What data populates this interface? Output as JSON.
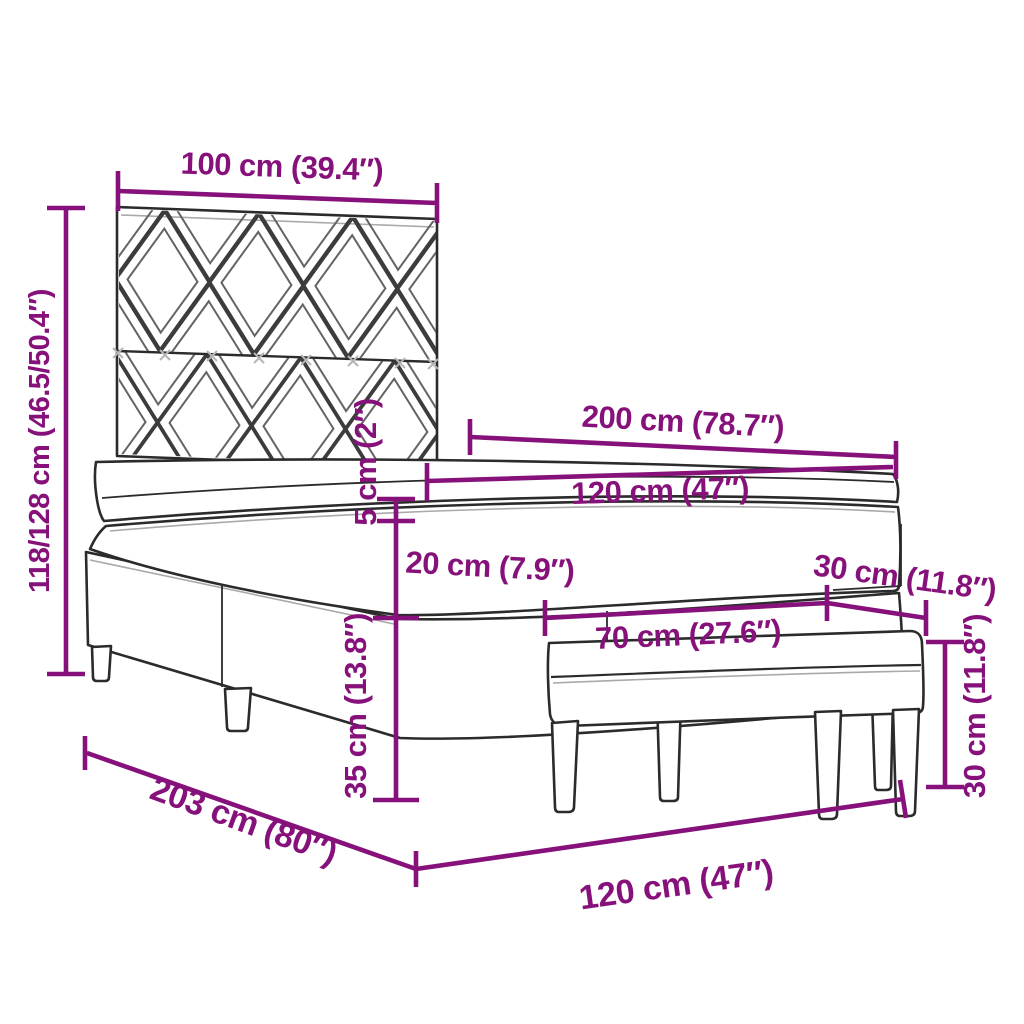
{
  "canvas": {
    "width": 1024,
    "height": 1024,
    "background": "#ffffff"
  },
  "colors": {
    "dimension_accent": "#87117b",
    "drawing_outline": "#2b2b2b",
    "pattern_line": "#3c3c3c",
    "shade_line": "#a9a9a9"
  },
  "dims": {
    "headboard_width": {
      "label": "100 cm (39.4″)"
    },
    "bed_height": {
      "label": "118/128 cm (46.5/50.4″)"
    },
    "bed_length": {
      "label": "200 cm (78.7″)"
    },
    "mattress_width": {
      "label": "120 cm (47″)"
    },
    "topper_thickness": {
      "label": "5 cm (2″)"
    },
    "mattress_thickness": {
      "label": "20 cm (7.9″)"
    },
    "bench_depth": {
      "label": "30 cm (11.8″)"
    },
    "bench_length": {
      "label": "70 cm (27.6″)"
    },
    "base_height": {
      "label": "35 cm (13.8″)"
    },
    "bench_height": {
      "label": "30 cm (11.8″)"
    },
    "frame_length": {
      "label": "203 cm (80″)"
    },
    "bed_width": {
      "label": "120 cm (47″)"
    }
  }
}
